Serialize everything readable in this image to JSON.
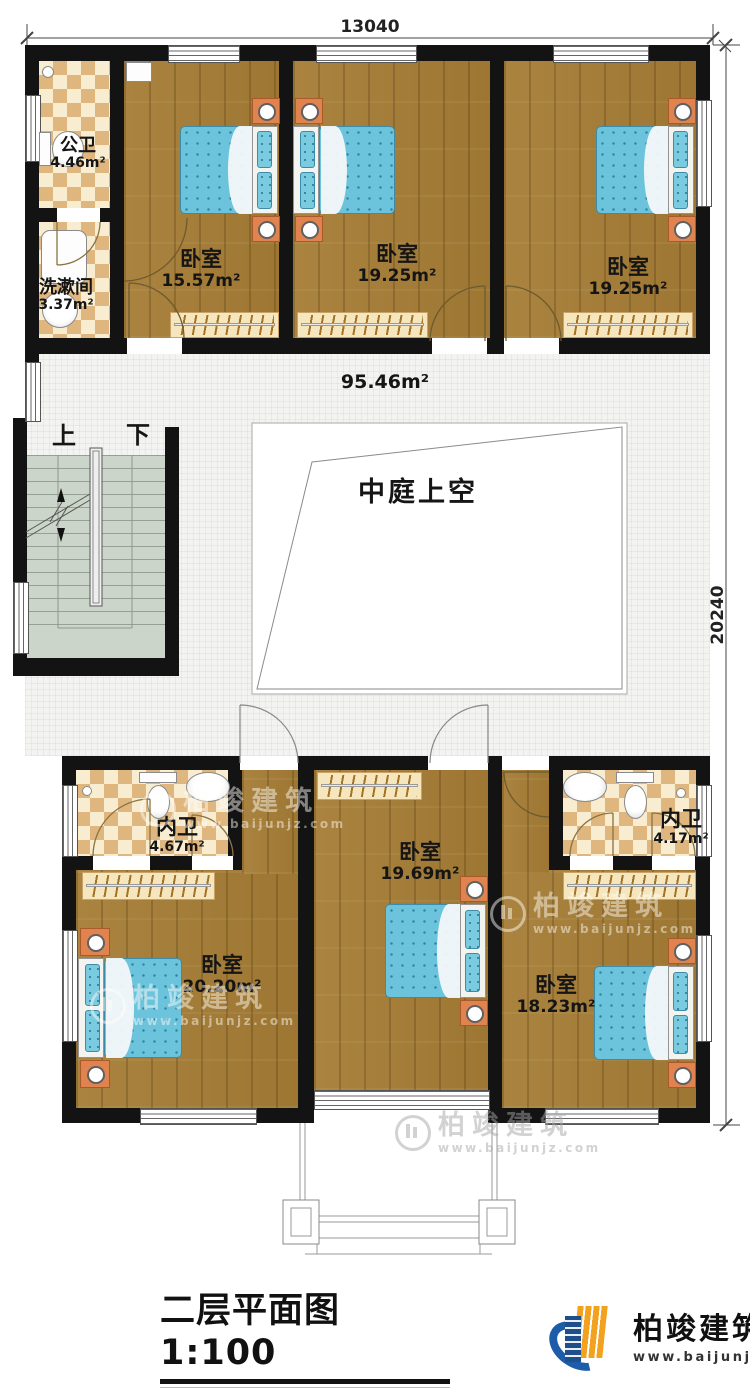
{
  "dimensions": {
    "width_label": "13040",
    "height_label": "20240"
  },
  "rooms": {
    "gongwei": {
      "label": "公卫",
      "area": "4.46m²"
    },
    "xishujian": {
      "label": "洗漱间",
      "area": "3.37m²"
    },
    "bedroom_top_left": {
      "label": "卧室",
      "area": "15.57m²"
    },
    "bedroom_top_middle": {
      "label": "卧室",
      "area": "19.25m²"
    },
    "bedroom_top_right": {
      "label": "卧室",
      "area": "19.25m²"
    },
    "hall": {
      "area": "95.46m²"
    },
    "atrium": {
      "label": "中庭上空"
    },
    "neiwei_left": {
      "label": "内卫",
      "area": "4.67m²"
    },
    "neiwei_right": {
      "label": "内卫",
      "area": "4.17m²"
    },
    "bedroom_bottom_left": {
      "label": "卧室",
      "area": "20.20m²"
    },
    "bedroom_bottom_middle": {
      "label": "卧室",
      "area": "19.69m²"
    },
    "bedroom_bottom_right": {
      "label": "卧室",
      "area": "18.23m²"
    }
  },
  "stairs": {
    "up_label": "上",
    "down_label": "下"
  },
  "title_block": {
    "title": "二层平面图1:100",
    "floor_area": "本层建筑面积：198.12m²",
    "floor_height": "层高：3.3m"
  },
  "branding": {
    "company": "柏竣建筑",
    "website": "www.baijunjz.com"
  },
  "watermark": {
    "company": "柏竣建筑",
    "website": "www.baijunjz.com"
  },
  "colors": {
    "wall": "#131313",
    "wood": "#a57d35",
    "bed_blue": "#6cc3dc",
    "tile_dark": "#e0b67f",
    "tile_light": "#f8ecd1",
    "logo_blue": "#1c5ca8",
    "logo_orange": "#f2a21f"
  }
}
